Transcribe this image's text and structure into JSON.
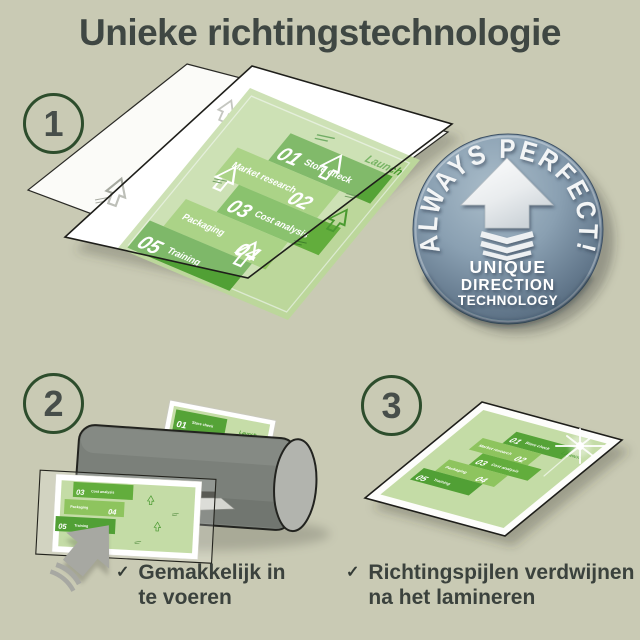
{
  "title": "Unieke richtingstechnologie",
  "steps": {
    "one": {
      "number": "1"
    },
    "two": {
      "number": "2",
      "check": "✓",
      "caption": [
        "Gemakkelijk in",
        "te voeren"
      ]
    },
    "three": {
      "number": "3",
      "check": "✓",
      "caption": [
        "Richtingspijlen verdwijnen",
        "na het lamineren"
      ]
    }
  },
  "badge": {
    "arc_text": "ALWAYS PERFECT!",
    "lines": [
      "UNIQUE",
      "DIRECTION",
      "TECHNOLOGY"
    ]
  },
  "doc": {
    "items": [
      {
        "num": "01",
        "label": "Store check"
      },
      {
        "num": "02",
        "label": "Market research"
      },
      {
        "num": "03",
        "label": "Cost analysis"
      },
      {
        "num": "04",
        "label": "Packaging"
      },
      {
        "num": "05",
        "label": "Training"
      }
    ],
    "launch_label": "Launch"
  },
  "colors": {
    "background": "#c9cab4",
    "title_text": "#3f4743",
    "page_green": "#bcd79b",
    "block_dark_green": "#55a337",
    "block_mid_green": "#8ec45e",
    "block_deep_green": "#62ad3c",
    "accent_green": "#4a9a30",
    "badge_face": "#8aa0b2",
    "badge_edge": "#4d6276",
    "machine_gray": "#7b807a"
  }
}
